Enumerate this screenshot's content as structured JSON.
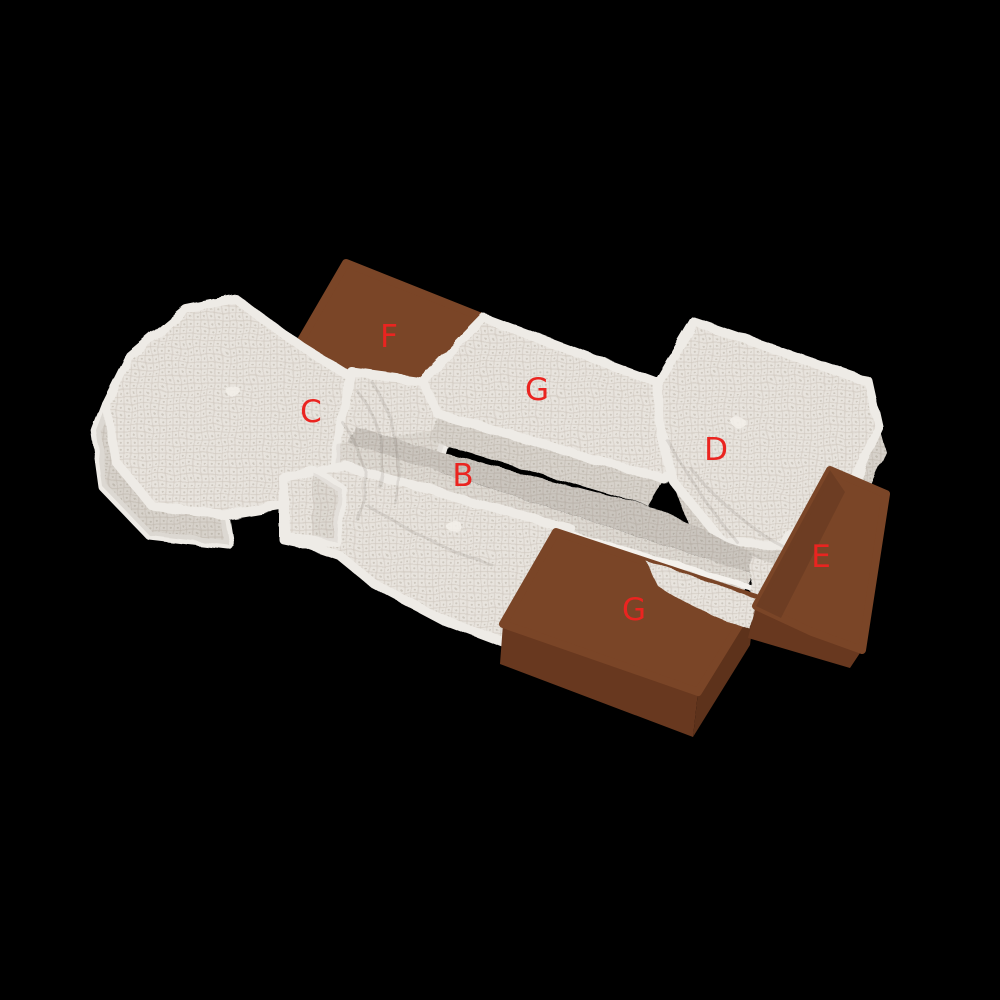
{
  "scene": {
    "background": "#000000",
    "labels": [
      {
        "char": "F"
      },
      {
        "char": "G"
      },
      {
        "char": "C"
      },
      {
        "char": "D"
      },
      {
        "char": "B"
      },
      {
        "char": "E"
      },
      {
        "char": "G"
      }
    ],
    "blocks": [
      {
        "label": "B",
        "material": "white-fabric"
      },
      {
        "label": "C",
        "material": "white-fabric"
      },
      {
        "label": "D",
        "material": "white-fabric"
      },
      {
        "label": "E",
        "material": "brown-box"
      },
      {
        "label": "F",
        "material": "brown-box"
      },
      {
        "label": "G",
        "material": "white-fabric"
      },
      {
        "label": "G",
        "material": "brown-box"
      }
    ]
  },
  "colors": {
    "background": "#000000",
    "label": "#ea2420",
    "leather_top": "#7a4527",
    "leather_front": "#68381f",
    "leather_side": "#5d321b",
    "fabric_base": "#e8e4de",
    "fabric_thread": "#cdc6bd",
    "fabric_dot": "#b4aba0",
    "fabric_edge": "#eeebe6"
  }
}
